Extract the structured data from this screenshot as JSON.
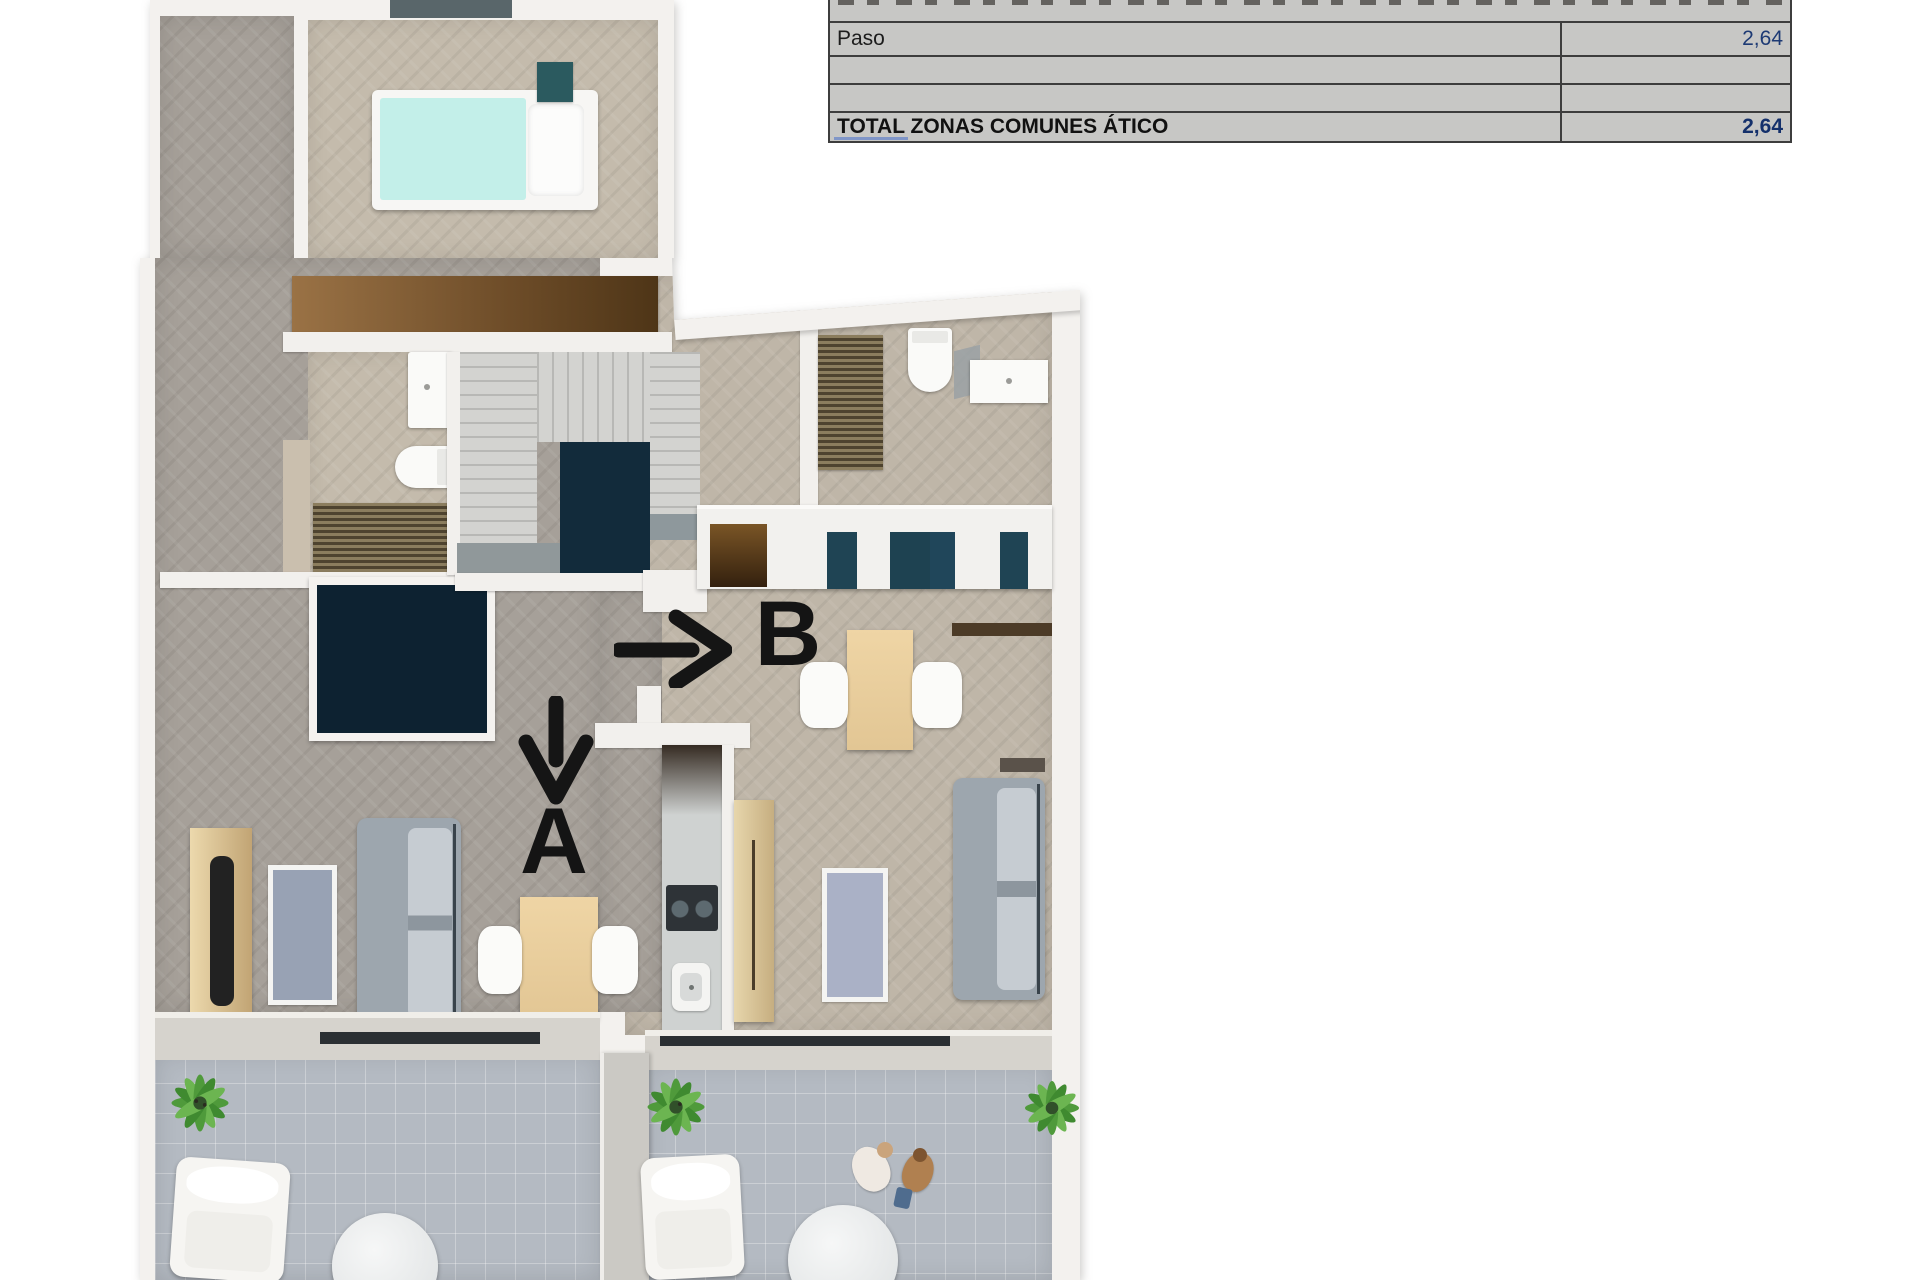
{
  "summary_table": {
    "rows": [
      {
        "label": "Paso",
        "value": "2,64"
      },
      {
        "label": "",
        "value": ""
      },
      {
        "label": "",
        "value": ""
      }
    ],
    "total_row": {
      "label": "TOTAL ZONAS COMUNES ÁTICO",
      "value": "2,64"
    }
  },
  "floor_plan": {
    "units": [
      {
        "label": "A",
        "arrow": "down"
      },
      {
        "label": "B",
        "arrow": "right"
      }
    ]
  },
  "colors": {
    "table_cell_bg": "#c7c7c5",
    "table_border": "#3d3d3d",
    "value_text": "#1d3a74",
    "total_value_text": "#14306b",
    "annotation_black": "#141414",
    "bed_cyan": "#c3efe9",
    "stair_void_navy": "#122b3b",
    "kitchen_teal": "#1f4454",
    "plant_green": "#4f9a3b",
    "floor_warm": "#bfb6a8",
    "floor_gray": "#a6a099",
    "terrace_floor": "#b4bac2"
  }
}
